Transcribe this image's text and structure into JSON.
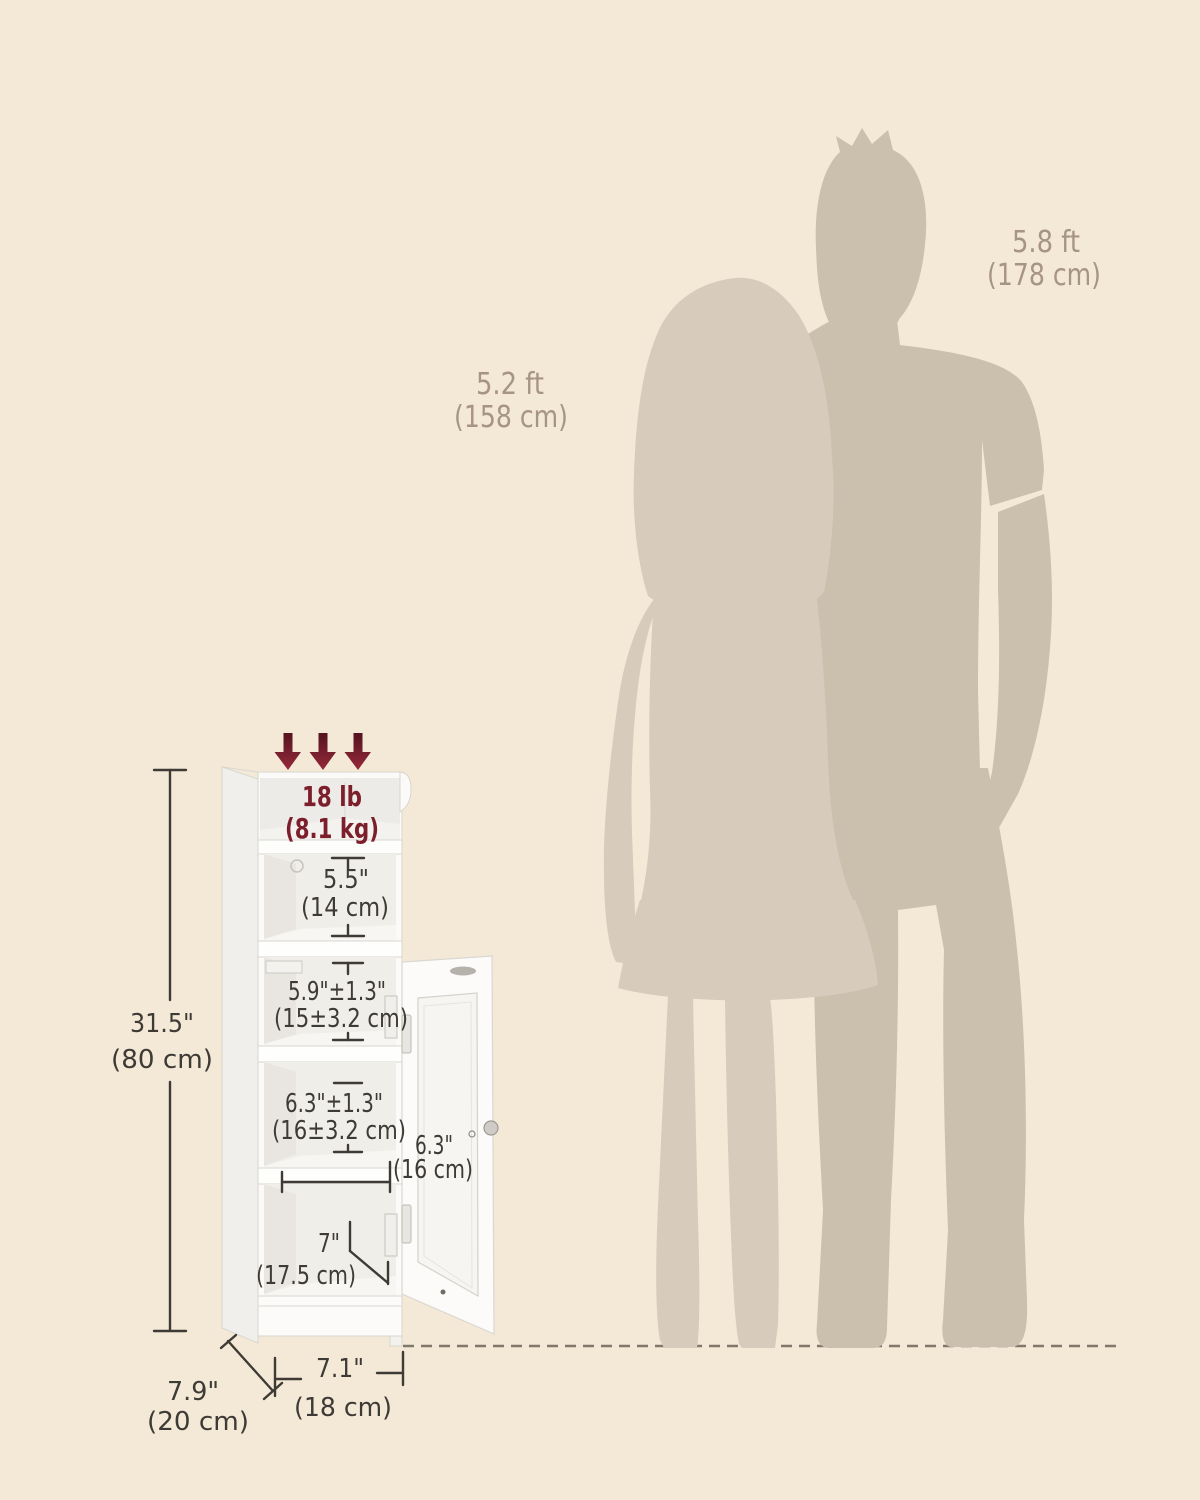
{
  "scene": {
    "background_color": "#f4e9d6",
    "silhouette_male_color": "#cbc0ae",
    "silhouette_female_color": "#d7ccbc",
    "accent_maroon": "#7c1e2c",
    "dimension_text_color": "#3e3a35",
    "reference_text_color": "#a69584",
    "cabinet_outline_color": "#d9d6d0",
    "floor_line_color": "#80786a"
  },
  "reference_people": {
    "female": {
      "height_ft": "5.2 ft",
      "height_cm": "(158 cm)"
    },
    "male": {
      "height_ft": "5.8 ft",
      "height_cm": "(178 cm)"
    }
  },
  "cabinet": {
    "max_load": {
      "pounds": "18 lb",
      "kilograms": "(8.1 kg)"
    },
    "overall_height": {
      "inches": "31.5\"",
      "centimeters": "(80 cm)"
    },
    "compartments": [
      {
        "inches": "5.5\"",
        "centimeters": "(14 cm)"
      },
      {
        "inches": "5.9\"±1.3\"",
        "centimeters": "(15±3.2 cm)"
      },
      {
        "inches": "6.3\"±1.3\"",
        "centimeters": "(16±3.2 cm)"
      },
      {
        "inches": "7\"",
        "centimeters": "(17.5 cm)"
      }
    ],
    "shelf_depth": {
      "inches": "6.3\"",
      "centimeters": "(16 cm)"
    },
    "base_depth": {
      "inches": "7.9\"",
      "centimeters": "(20 cm)"
    },
    "base_width": {
      "inches": "7.1\"",
      "centimeters": "(18 cm)"
    }
  }
}
